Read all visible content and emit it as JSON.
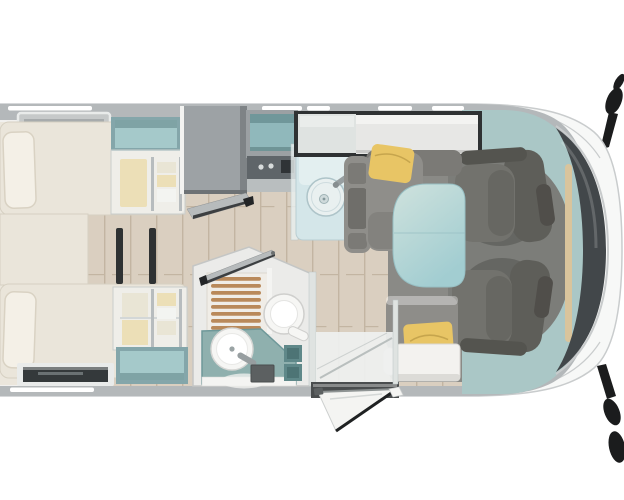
{
  "scene": {
    "type": "motorhome-floor-plan",
    "view": "top-down",
    "areas": [
      "rear-twin-single-beds",
      "foot-end-wardrobes",
      "refrigerator-with-open-flap",
      "kitchen-block-with-round-sink",
      "bathroom-shower-toilet-washbasin",
      "dinette-bench-seats-with-table",
      "swivelled-cab-seats",
      "open-entry-door",
      "cab-front-with-side-mirrors"
    ]
  },
  "colors": {
    "canvas": "#ffffff",
    "body_outline": "#c9cccd",
    "body_shell_white": "#f7f8f7",
    "body_band": "#b4b8ba",
    "interior_white": "#f1f0ee",
    "wood_base": "#dacfc0",
    "wood_stripe": "#c3b5a2",
    "bedroom_floor": "#ebe6dc",
    "bed_cream": "#eae5da",
    "bed_edge": "#d6d0c2",
    "pillow_white": "#f4f0e7",
    "pillow_edge": "#d9d2c3",
    "roof_strip": "#ffffff",
    "vent_gray": "#c6c9c9",
    "vent_frame": "#e9ebea",
    "vent_slat": "#a7abac",
    "vent_dark": "#34393b",
    "vent_mid": "#6a7173",
    "window_frame": "#84a6aa",
    "window_teal": "#a5c9ca",
    "window_shadow": "rgba(40,75,80,0.30)",
    "frost_glass": "rgba(243,246,245,0.55)",
    "frost_stroke": "#c9cdcc",
    "clothes_yellow": "#e5c36c",
    "clothes_beige": "#ddd0ae",
    "clothes_white": "#f4f2ec",
    "rail_dark": "#70767a",
    "shelf_gray": "#adb2b1",
    "leg_dark": "#2f3233",
    "fridge_gray": "#9da2a5",
    "fridge_dark": "#7e8386",
    "fridge_edge": "#6d7275",
    "flap_gray": "#b7bbbc",
    "flap_stroke": "#8e9294",
    "flap_edge": "#3c3f41",
    "flap_tip": "#232527",
    "cab_open_frame": "#9ba0a3",
    "cab_open_teal": "#90b8bb",
    "open_shelf": "#6f9496",
    "hob_dark": "#5f6569",
    "hob_knob": "#d8dcdc",
    "hob_block": "#2f3336",
    "counter_step": "#b9bebf",
    "counter_glass": "rgba(233,240,240,0.8)",
    "glass_edge": "#b9c4c4",
    "counter_blue": "#d4e6e9",
    "counter_edge": "#b9cdd2",
    "sink_white": "#e9f0f0",
    "sink_rim": "#aec4c9",
    "sink_drain": "#cfdadb",
    "drain_edge": "#9fb2b5",
    "drain_dot": "#85989b",
    "faucet_gray": "#979ea0",
    "faucet_dark": "#878e90",
    "dark_frame": "#2f3233",
    "frost_window": "#dfe3e1",
    "locker_white": "#e7e7e5",
    "locker_top": "#f3f3f1",
    "locker_edge": "#c9c9c7",
    "sofa_gray": "#8f8e8a",
    "sofa_dark": "#7b7a76",
    "armrest_dark": "#6f6e6a",
    "cushion_yellow": "#e8c565",
    "cushion_fold": "#c6a54d",
    "table_light": "#cfe2dd",
    "table_dark": "#a2cdd1",
    "table_edge": "#97bfc3",
    "dinette_mat": "#8a8a86",
    "bench_back": "#8e8d89",
    "bench_white": "#f3f2ef",
    "bench_edge": "#d8d7d3",
    "bench_shadow": "#dcdbd7",
    "cab_teal": "#aac7c6",
    "cab_floor": "#7c7d79",
    "cab_floor_dark": "rgba(42,42,40,0.28)",
    "pillar_tan": "#d9c49c",
    "windshield_dark": "#42474a",
    "windshield_frame": "#c8cbcc",
    "seat_gray": "#72726d",
    "seat_back": "#5e5e59",
    "seat_arm": "#54544f",
    "headrest": "#504e4a",
    "mirror_black": "#1b1c1d",
    "bath_wall": "#ebebe9",
    "bath_wall_edge": "#c4c6c5",
    "shower_base": "#f0ede7",
    "shower_edge": "#dbd7cf",
    "shower_wood": "#b9895a",
    "partition_white": "#f4f4f2",
    "toilet_white": "#f6f6f4",
    "toilet_edge": "#cfcfcd",
    "toilet_inner_edge": "#e4e4e2",
    "vanity_teal": "#8fb0ae",
    "vanity_edge": "#6e9899",
    "sink2_edge": "#d6d6d4",
    "sink2_inner_edge": "#e9e9e7",
    "sink2_dot": "#9aa3a4",
    "trash_gray": "#5c6061",
    "trash_edge": "#4a4e4f",
    "teal_box": "#5f8889",
    "teal_box_dark": "#4d7475",
    "hinge_gray": "#6b6f70",
    "threshold_dark": "#4a4d4e",
    "glass_line": "#b9bfbe",
    "step_white": "#eef0ef",
    "door_white": "#f4f4f2",
    "door_pale_edge": "#cdd0cf",
    "door_edge_dark": "#1f2122",
    "door_inner": "#d4d7d6",
    "door_top": "#8f9494",
    "highlight_soft": "rgba(255,255,255,0.35)"
  }
}
